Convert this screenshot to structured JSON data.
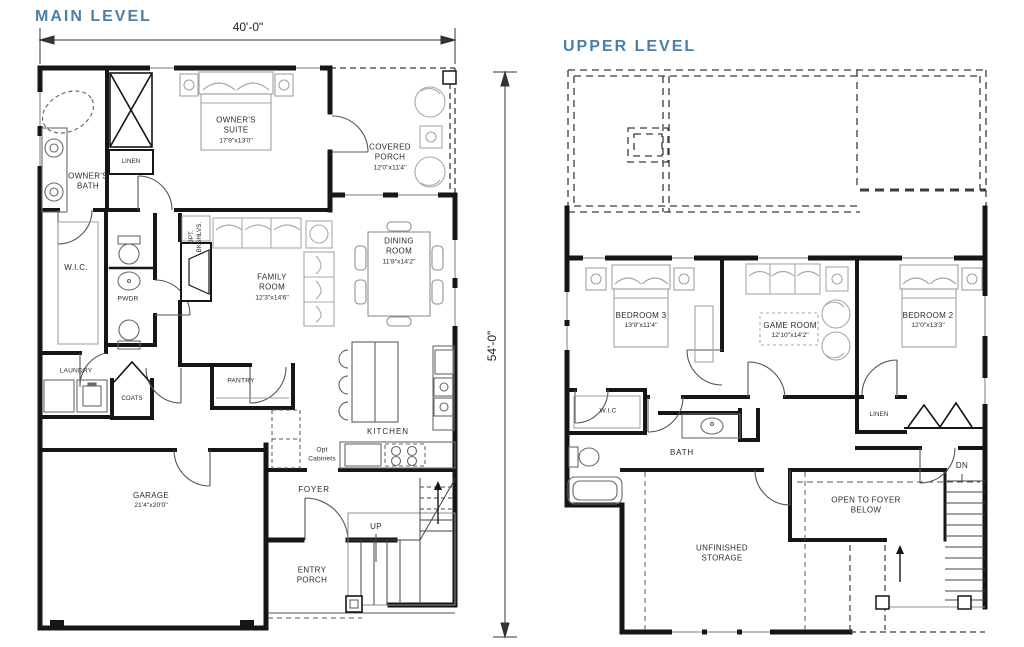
{
  "titles": {
    "main": "MAIN LEVEL",
    "upper": "UPPER LEVEL"
  },
  "dimensions": {
    "overall_width": "40'-0\"",
    "overall_height": "54'-0\""
  },
  "colors": {
    "title_blue": "#4a7fa8",
    "wall": "#161616",
    "furniture": "#9c9c9c",
    "label": "#2b2b2b"
  },
  "main_level": {
    "rooms": {
      "owners_suite": {
        "name": "OWNER'S SUITE",
        "dims": "17'9\"x13'0\""
      },
      "covered_porch": {
        "name": "COVERED PORCH",
        "dims": "12'0\"x11'4\""
      },
      "owners_bath": {
        "name": "OWNER'S BATH"
      },
      "linen": {
        "name": "LINEN"
      },
      "wic": {
        "name": "W.I.C."
      },
      "pwdr": {
        "name": "PWDR"
      },
      "family_room": {
        "name": "FAMILY ROOM",
        "dims": "12'3\"x14'6\""
      },
      "dining_room": {
        "name": "DINING ROOM",
        "dims": "11'8\"x14'2\""
      },
      "laundry": {
        "name": "LAUNDRY"
      },
      "coats": {
        "name": "COATS"
      },
      "pantry": {
        "name": "PANTRY"
      },
      "kitchen": {
        "name": "KITCHEN"
      },
      "opt_cabinets": {
        "name": "Opt Cabinets"
      },
      "opt_bkshlvs": {
        "name": "OPT. BKSHLVS."
      },
      "garage": {
        "name": "GARAGE",
        "dims": "21'4\"x20'0\""
      },
      "foyer": {
        "name": "FOYER"
      },
      "up": {
        "name": "UP"
      },
      "entry_porch": {
        "name": "ENTRY PORCH"
      }
    }
  },
  "upper_level": {
    "rooms": {
      "bedroom3": {
        "name": "BEDROOM 3",
        "dims": "13'9\"x11'4\""
      },
      "game_room": {
        "name": "GAME ROOM",
        "dims": "12'10\"x14'2\""
      },
      "bedroom2": {
        "name": "BEDROOM 2",
        "dims": "12'0\"x13'3\""
      },
      "wic": {
        "name": "W.I.C"
      },
      "bath": {
        "name": "BATH"
      },
      "linen": {
        "name": "LINEN"
      },
      "storage": {
        "name": "UNFINISHED STORAGE"
      },
      "open_to_foyer": {
        "name": "OPEN TO FOYER BELOW"
      },
      "dn": {
        "name": "DN"
      }
    }
  }
}
